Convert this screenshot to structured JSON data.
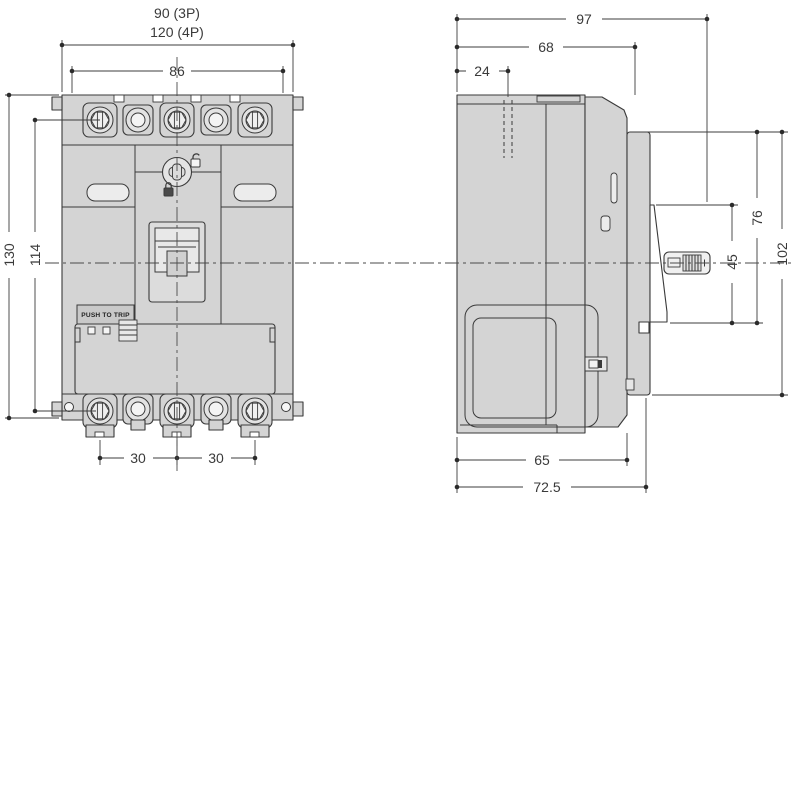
{
  "colors": {
    "background": "#ffffff",
    "line": "#3a3a3a",
    "body_fill": "#d4d4d4",
    "detail_fill": "#ececec"
  },
  "front_view": {
    "dims": {
      "width_3p": "90 (3P)",
      "width_4p": "120 (4P)",
      "terminal_span": "86",
      "height": "130",
      "mount_height": "114",
      "pole_pitch_1": "30",
      "pole_pitch_2": "30"
    },
    "labels": {
      "push_to_trip": "PUSH TO TRIP"
    },
    "icons": {
      "padlock_locked_icon": "locked-padlock",
      "padlock_unlocked_icon": "unlocked-padlock",
      "rotary_screw_icon": "phillips-rotary-lock"
    }
  },
  "side_view": {
    "dims": {
      "depth_total": "97",
      "depth_body": "68",
      "depth_recess": "24",
      "height_cover": "76",
      "height_escutcheon": "45",
      "height_front": "102",
      "base_depth": "65",
      "base_depth_total": "72.5"
    }
  }
}
